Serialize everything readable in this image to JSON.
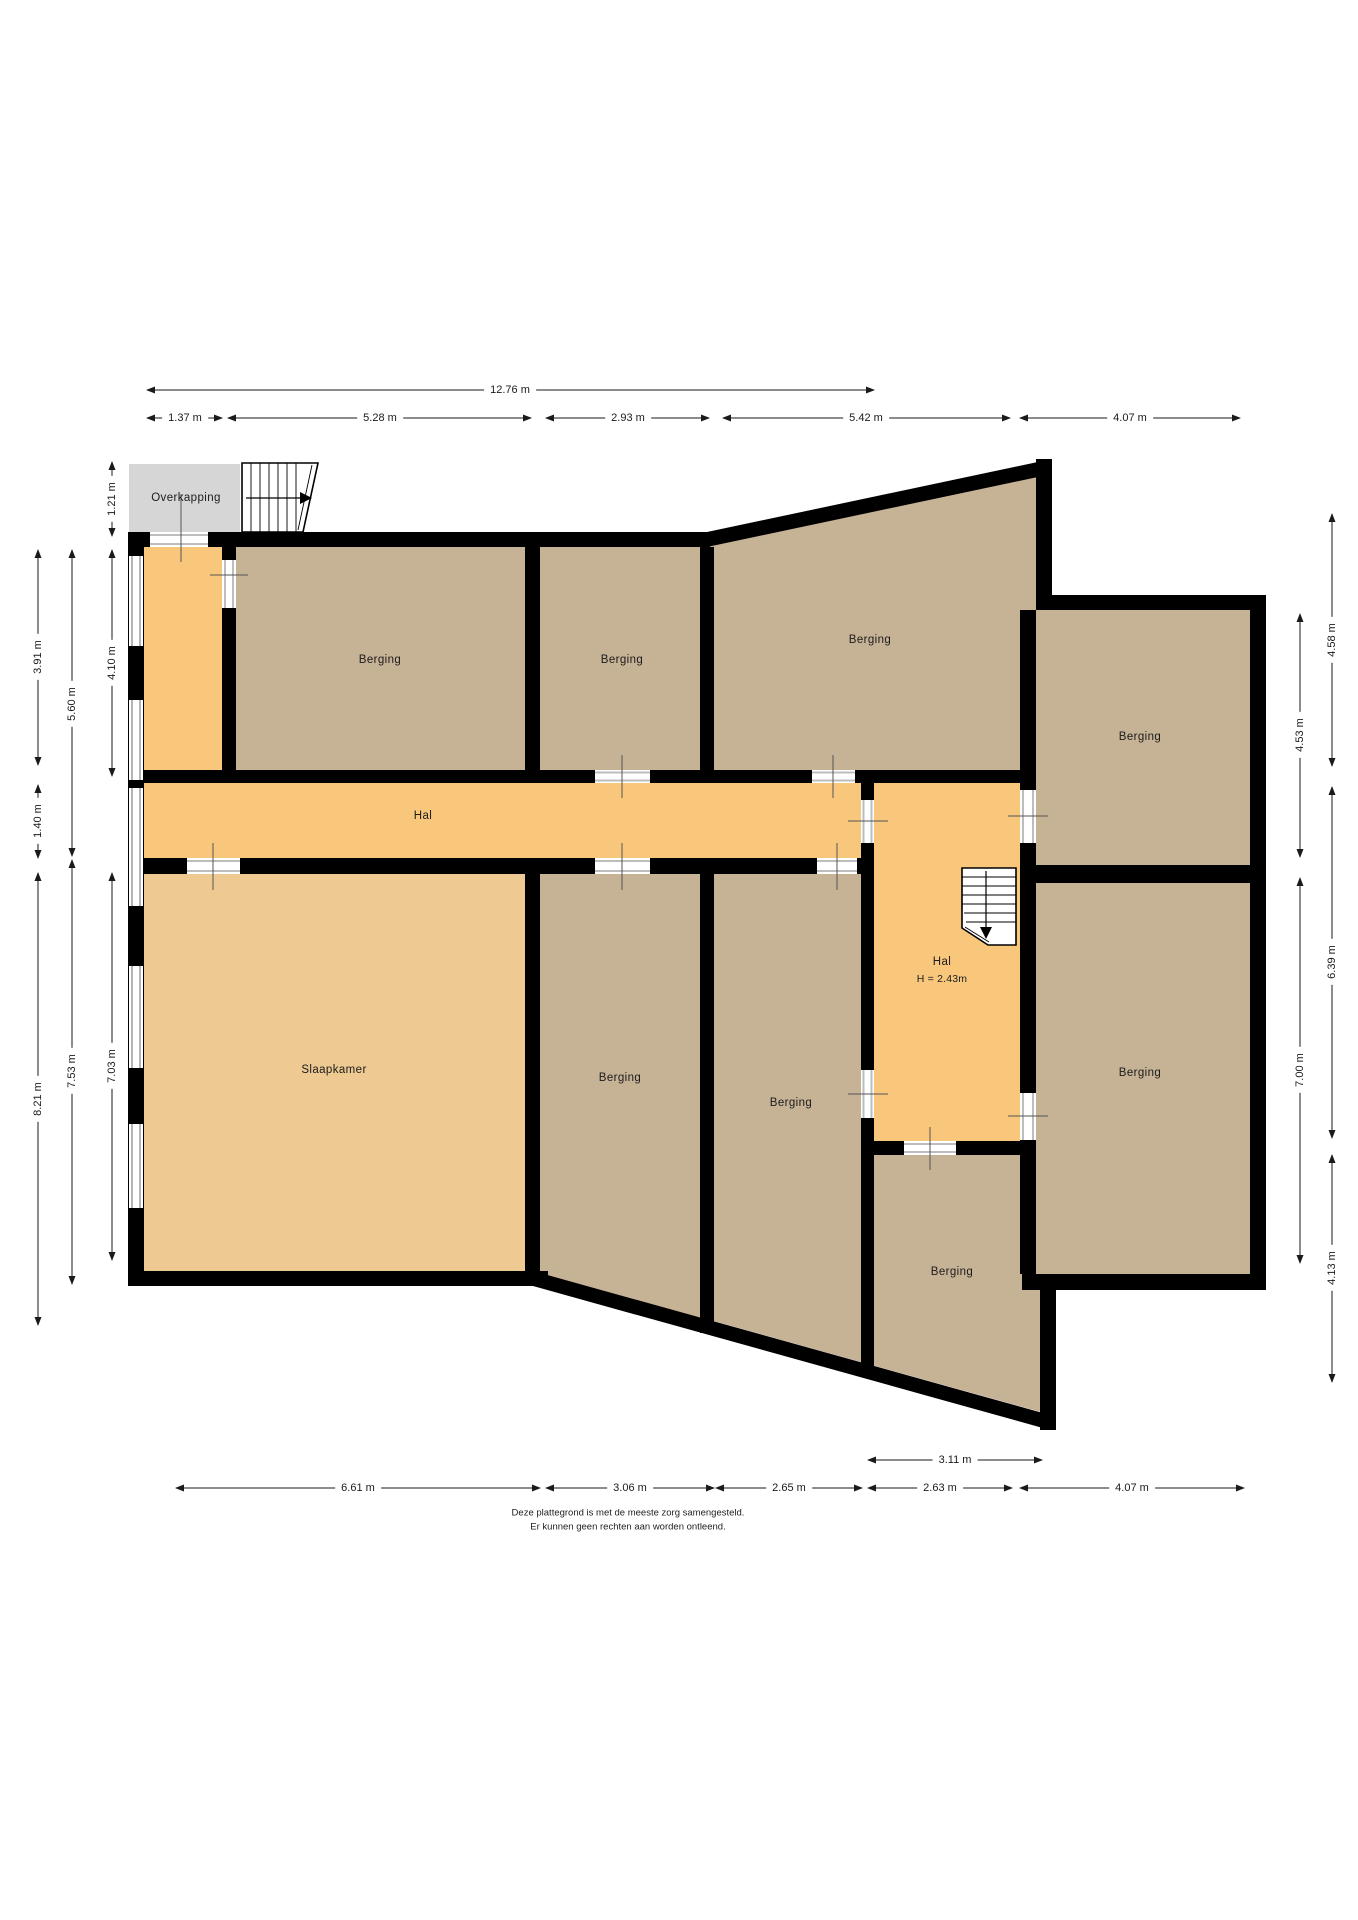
{
  "colors": {
    "wall": "#000000",
    "berging": "#c6b295",
    "hal": "#f8c77c",
    "slaapkamer": "#eeca92",
    "overkapping": "#d6d6d6",
    "dim_line": "#1a1a1a",
    "door_frame": "#bdbdbd",
    "window_frame": "#b5b5b5",
    "door_tick": "#555555"
  },
  "rooms": {
    "overkapping": {
      "label": "Overkapping"
    },
    "berging_top_left": {
      "label": "Berging"
    },
    "berging_top_mid": {
      "label": "Berging"
    },
    "berging_top_right": {
      "label": "Berging"
    },
    "berging_right_upper": {
      "label": "Berging"
    },
    "berging_right_lower": {
      "label": "Berging"
    },
    "hal_corridor": {
      "label": "Hal"
    },
    "hal_lower": {
      "label": "Hal",
      "height": "H = 2.43m"
    },
    "slaapkamer": {
      "label": "Slaapkamer"
    },
    "berging_center_left": {
      "label": "Berging"
    },
    "berging_center_right": {
      "label": "Berging"
    },
    "berging_bottom": {
      "label": "Berging"
    }
  },
  "dimensions": {
    "top": [
      {
        "text": "12.76 m"
      },
      {
        "text": "1.37 m"
      },
      {
        "text": "5.28 m"
      },
      {
        "text": "2.93 m"
      },
      {
        "text": "5.42 m"
      },
      {
        "text": "4.07 m"
      }
    ],
    "left": [
      {
        "text": "1.21 m"
      },
      {
        "text": "4.10 m"
      },
      {
        "text": "7.03 m"
      },
      {
        "text": "5.60 m"
      },
      {
        "text": "7.53 m"
      },
      {
        "text": "3.91 m"
      },
      {
        "text": "1.40 m"
      },
      {
        "text": "8.21 m"
      }
    ],
    "right": [
      {
        "text": "4.53 m"
      },
      {
        "text": "7.00 m"
      },
      {
        "text": "4.58 m"
      },
      {
        "text": "6.39 m"
      },
      {
        "text": "4.13 m"
      }
    ],
    "bottom": [
      {
        "text": "3.11 m"
      },
      {
        "text": "6.61 m"
      },
      {
        "text": "3.06 m"
      },
      {
        "text": "2.65 m"
      },
      {
        "text": "2.63 m"
      },
      {
        "text": "4.07 m"
      }
    ]
  },
  "footer": {
    "line1": "Deze plattegrond is met de meeste zorg samengesteld.",
    "line2": "Er kunnen geen rechten aan worden ontleend."
  }
}
